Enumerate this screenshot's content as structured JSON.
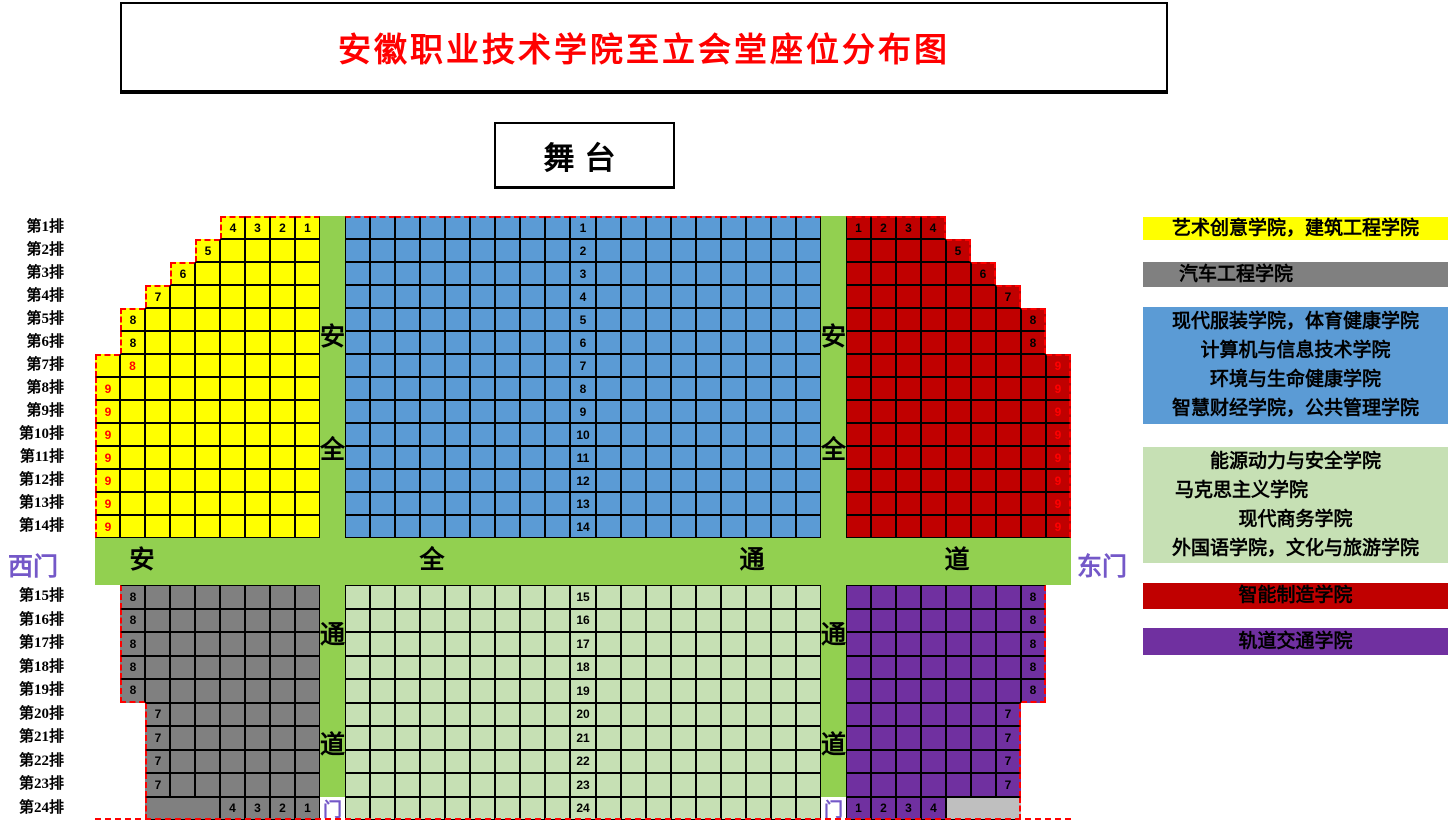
{
  "title": {
    "text": "安徽职业技术学院至立会堂座位分布图"
  },
  "stage": {
    "label": "舞台"
  },
  "gates": {
    "west": "西门",
    "east": "东门",
    "door": "门"
  },
  "aisles": {
    "horizontal_chars": [
      "安",
      "全",
      "通",
      "道"
    ],
    "vertical_top_chars": [
      "安",
      "全"
    ],
    "vertical_bottom_chars": [
      "通",
      "道"
    ]
  },
  "row_labels": [
    "第1排",
    "第2排",
    "第3排",
    "第4排",
    "第5排",
    "第6排",
    "第7排",
    "第8排",
    "第9排",
    "第10排",
    "第11排",
    "第12排",
    "第13排",
    "第14排",
    "第15排",
    "第16排",
    "第17排",
    "第18排",
    "第19排",
    "第20排",
    "第21排",
    "第22排",
    "第23排",
    "第24排"
  ],
  "colors": {
    "yellow": "#FFFF00",
    "blue": "#5B9BD5",
    "dark_red": "#C00000",
    "gray": "#808080",
    "light_green": "#C6E0B4",
    "aisle_green": "#92D050",
    "purple": "#7030A0",
    "light_gray": "#BFBFBF",
    "label_red": "#FF0000",
    "title_red": "#FF0000",
    "gate_purple": "#7458C8",
    "dash_red": "#FF0000"
  },
  "sections": {
    "front_left": {
      "color_key": "yellow",
      "rows": [
        {
          "row": 1,
          "start": 5,
          "seats": 4,
          "labels": [
            {
              "pos": 0,
              "text": "4"
            },
            {
              "pos": 1,
              "text": "3"
            },
            {
              "pos": 2,
              "text": "2"
            },
            {
              "pos": 3,
              "text": "1"
            }
          ]
        },
        {
          "row": 2,
          "start": 4,
          "seats": 5,
          "labels": [
            {
              "pos": 0,
              "text": "5"
            }
          ]
        },
        {
          "row": 3,
          "start": 3,
          "seats": 6,
          "labels": [
            {
              "pos": 0,
              "text": "6"
            }
          ]
        },
        {
          "row": 4,
          "start": 2,
          "seats": 7,
          "labels": [
            {
              "pos": 0,
              "text": "7"
            }
          ]
        },
        {
          "row": 5,
          "start": 1,
          "seats": 8,
          "labels": [
            {
              "pos": 0,
              "text": "8"
            }
          ]
        },
        {
          "row": 6,
          "start": 1,
          "seats": 8,
          "labels": [
            {
              "pos": 0,
              "text": "8"
            }
          ]
        },
        {
          "row": 7,
          "start": 0,
          "seats": 9,
          "labels": [
            {
              "pos": 1,
              "text": "8",
              "red": true
            }
          ]
        },
        {
          "row": 8,
          "start": 0,
          "seats": 9,
          "labels": [
            {
              "pos": 0,
              "text": "9",
              "red": true
            }
          ]
        },
        {
          "row": 9,
          "start": 0,
          "seats": 9,
          "labels": [
            {
              "pos": 0,
              "text": "9",
              "red": true
            }
          ]
        },
        {
          "row": 10,
          "start": 0,
          "seats": 9,
          "labels": [
            {
              "pos": 0,
              "text": "9",
              "red": true
            }
          ]
        },
        {
          "row": 11,
          "start": 0,
          "seats": 9,
          "labels": [
            {
              "pos": 0,
              "text": "9",
              "red": true
            }
          ]
        },
        {
          "row": 12,
          "start": 0,
          "seats": 9,
          "labels": [
            {
              "pos": 0,
              "text": "9",
              "red": true
            }
          ]
        },
        {
          "row": 13,
          "start": 0,
          "seats": 9,
          "labels": [
            {
              "pos": 0,
              "text": "9",
              "red": true
            }
          ]
        },
        {
          "row": 14,
          "start": 0,
          "seats": 9,
          "labels": [
            {
              "pos": 0,
              "text": "9",
              "red": true
            }
          ]
        }
      ]
    },
    "front_center": {
      "color_key": "blue",
      "first_row": 1,
      "rows": [
        "1",
        "2",
        "3",
        "4",
        "5",
        "6",
        "7",
        "8",
        "9",
        "10",
        "11",
        "12",
        "13",
        "14"
      ]
    },
    "front_right": {
      "color_key": "dark_red",
      "rows": [
        {
          "row": 1,
          "start": 0,
          "seats": 4,
          "labels": [
            {
              "pos": 0,
              "text": "1"
            },
            {
              "pos": 1,
              "text": "2"
            },
            {
              "pos": 2,
              "text": "3"
            },
            {
              "pos": 3,
              "text": "4"
            }
          ]
        },
        {
          "row": 2,
          "start": 0,
          "seats": 5,
          "labels": [
            {
              "pos": 4,
              "text": "5"
            }
          ]
        },
        {
          "row": 3,
          "start": 0,
          "seats": 6,
          "labels": [
            {
              "pos": 5,
              "text": "6"
            }
          ]
        },
        {
          "row": 4,
          "start": 0,
          "seats": 7,
          "labels": [
            {
              "pos": 6,
              "text": "7"
            }
          ]
        },
        {
          "row": 5,
          "start": 0,
          "seats": 8,
          "labels": [
            {
              "pos": 7,
              "text": "8"
            }
          ]
        },
        {
          "row": 6,
          "start": 0,
          "seats": 8,
          "labels": [
            {
              "pos": 7,
              "text": "8"
            }
          ]
        },
        {
          "row": 7,
          "start": 0,
          "seats": 9,
          "labels": [
            {
              "pos": 8,
              "text": "9",
              "red": true
            }
          ]
        },
        {
          "row": 8,
          "start": 0,
          "seats": 9,
          "labels": [
            {
              "pos": 8,
              "text": "9",
              "red": true
            }
          ]
        },
        {
          "row": 9,
          "start": 0,
          "seats": 9,
          "labels": [
            {
              "pos": 8,
              "text": "9",
              "red": true
            }
          ]
        },
        {
          "row": 10,
          "start": 0,
          "seats": 9,
          "labels": [
            {
              "pos": 8,
              "text": "9",
              "red": true
            }
          ]
        },
        {
          "row": 11,
          "start": 0,
          "seats": 9,
          "labels": [
            {
              "pos": 8,
              "text": "9",
              "red": true
            }
          ]
        },
        {
          "row": 12,
          "start": 0,
          "seats": 9,
          "labels": [
            {
              "pos": 8,
              "text": "9",
              "red": true
            }
          ]
        },
        {
          "row": 13,
          "start": 0,
          "seats": 9,
          "labels": [
            {
              "pos": 8,
              "text": "9",
              "red": true
            }
          ]
        },
        {
          "row": 14,
          "start": 0,
          "seats": 9,
          "labels": [
            {
              "pos": 8,
              "text": "9",
              "red": true
            }
          ]
        }
      ]
    },
    "rear_left": {
      "color_key": "gray",
      "rows": [
        {
          "row": 15,
          "start": 1,
          "seats": 8,
          "labels": [
            {
              "pos": 0,
              "text": "8"
            }
          ]
        },
        {
          "row": 16,
          "start": 1,
          "seats": 8,
          "labels": [
            {
              "pos": 0,
              "text": "8"
            }
          ]
        },
        {
          "row": 17,
          "start": 1,
          "seats": 8,
          "labels": [
            {
              "pos": 0,
              "text": "8"
            }
          ]
        },
        {
          "row": 18,
          "start": 1,
          "seats": 8,
          "labels": [
            {
              "pos": 0,
              "text": "8"
            }
          ]
        },
        {
          "row": 19,
          "start": 1,
          "seats": 8,
          "labels": [
            {
              "pos": 0,
              "text": "8"
            }
          ]
        },
        {
          "row": 20,
          "start": 2,
          "seats": 7,
          "labels": [
            {
              "pos": 0,
              "text": "7"
            }
          ]
        },
        {
          "row": 21,
          "start": 2,
          "seats": 7,
          "labels": [
            {
              "pos": 0,
              "text": "7"
            }
          ]
        },
        {
          "row": 22,
          "start": 2,
          "seats": 7,
          "labels": [
            {
              "pos": 0,
              "text": "7"
            }
          ]
        },
        {
          "row": 23,
          "start": 2,
          "seats": 7,
          "labels": [
            {
              "pos": 0,
              "text": "7"
            }
          ]
        },
        {
          "row": 24,
          "start": 2,
          "seats": 7,
          "merge": {
            "pos": 0,
            "span": 3
          },
          "labels": [
            {
              "pos": 3,
              "text": "4"
            },
            {
              "pos": 4,
              "text": "3"
            },
            {
              "pos": 5,
              "text": "2"
            },
            {
              "pos": 6,
              "text": "1"
            }
          ]
        }
      ]
    },
    "rear_center": {
      "color_key": "light_green",
      "first_row": 15,
      "rows": [
        "15",
        "16",
        "17",
        "18",
        "19",
        "20",
        "21",
        "22",
        "23",
        "24"
      ]
    },
    "rear_right": {
      "color_key": "purple",
      "rows": [
        {
          "row": 15,
          "start": 0,
          "seats": 8,
          "labels": [
            {
              "pos": 7,
              "text": "8"
            }
          ]
        },
        {
          "row": 16,
          "start": 0,
          "seats": 8,
          "labels": [
            {
              "pos": 7,
              "text": "8"
            }
          ]
        },
        {
          "row": 17,
          "start": 0,
          "seats": 8,
          "labels": [
            {
              "pos": 7,
              "text": "8"
            }
          ]
        },
        {
          "row": 18,
          "start": 0,
          "seats": 8,
          "labels": [
            {
              "pos": 7,
              "text": "8"
            }
          ]
        },
        {
          "row": 19,
          "start": 0,
          "seats": 8,
          "labels": [
            {
              "pos": 7,
              "text": "8"
            }
          ]
        },
        {
          "row": 20,
          "start": 0,
          "seats": 7,
          "labels": [
            {
              "pos": 6,
              "text": "7"
            }
          ]
        },
        {
          "row": 21,
          "start": 0,
          "seats": 7,
          "labels": [
            {
              "pos": 6,
              "text": "7"
            }
          ]
        },
        {
          "row": 22,
          "start": 0,
          "seats": 7,
          "labels": [
            {
              "pos": 6,
              "text": "7"
            }
          ]
        },
        {
          "row": 23,
          "start": 0,
          "seats": 7,
          "labels": [
            {
              "pos": 6,
              "text": "7"
            }
          ]
        },
        {
          "row": 24,
          "start": 0,
          "seats": 7,
          "merge": {
            "pos": 4,
            "span": 3,
            "color_key": "light_gray"
          },
          "labels": [
            {
              "pos": 0,
              "text": "1"
            },
            {
              "pos": 1,
              "text": "2"
            },
            {
              "pos": 2,
              "text": "3"
            },
            {
              "pos": 3,
              "text": "4"
            }
          ]
        }
      ]
    }
  },
  "legend": [
    {
      "color_key": "yellow",
      "lines": [
        "艺术创意学院，建筑工程学院"
      ]
    },
    {
      "color_key": "gray",
      "lines": [
        "汽车工程学院"
      ]
    },
    {
      "color_key": "blue",
      "lines": [
        "现代服装学院，体育健康学院",
        "计算机与信息技术学院",
        "环境与生命健康学院",
        "智慧财经学院，公共管理学院"
      ]
    },
    {
      "color_key": "light_green",
      "lines": [
        "能源动力与安全学院",
        "马克思主义学院",
        "现代商务学院",
        "外国语学院，文化与旅游学院"
      ]
    },
    {
      "color_key": "dark_red",
      "lines": [
        "智能制造学院"
      ]
    },
    {
      "color_key": "purple",
      "lines": [
        "轨道交通学院"
      ]
    }
  ]
}
